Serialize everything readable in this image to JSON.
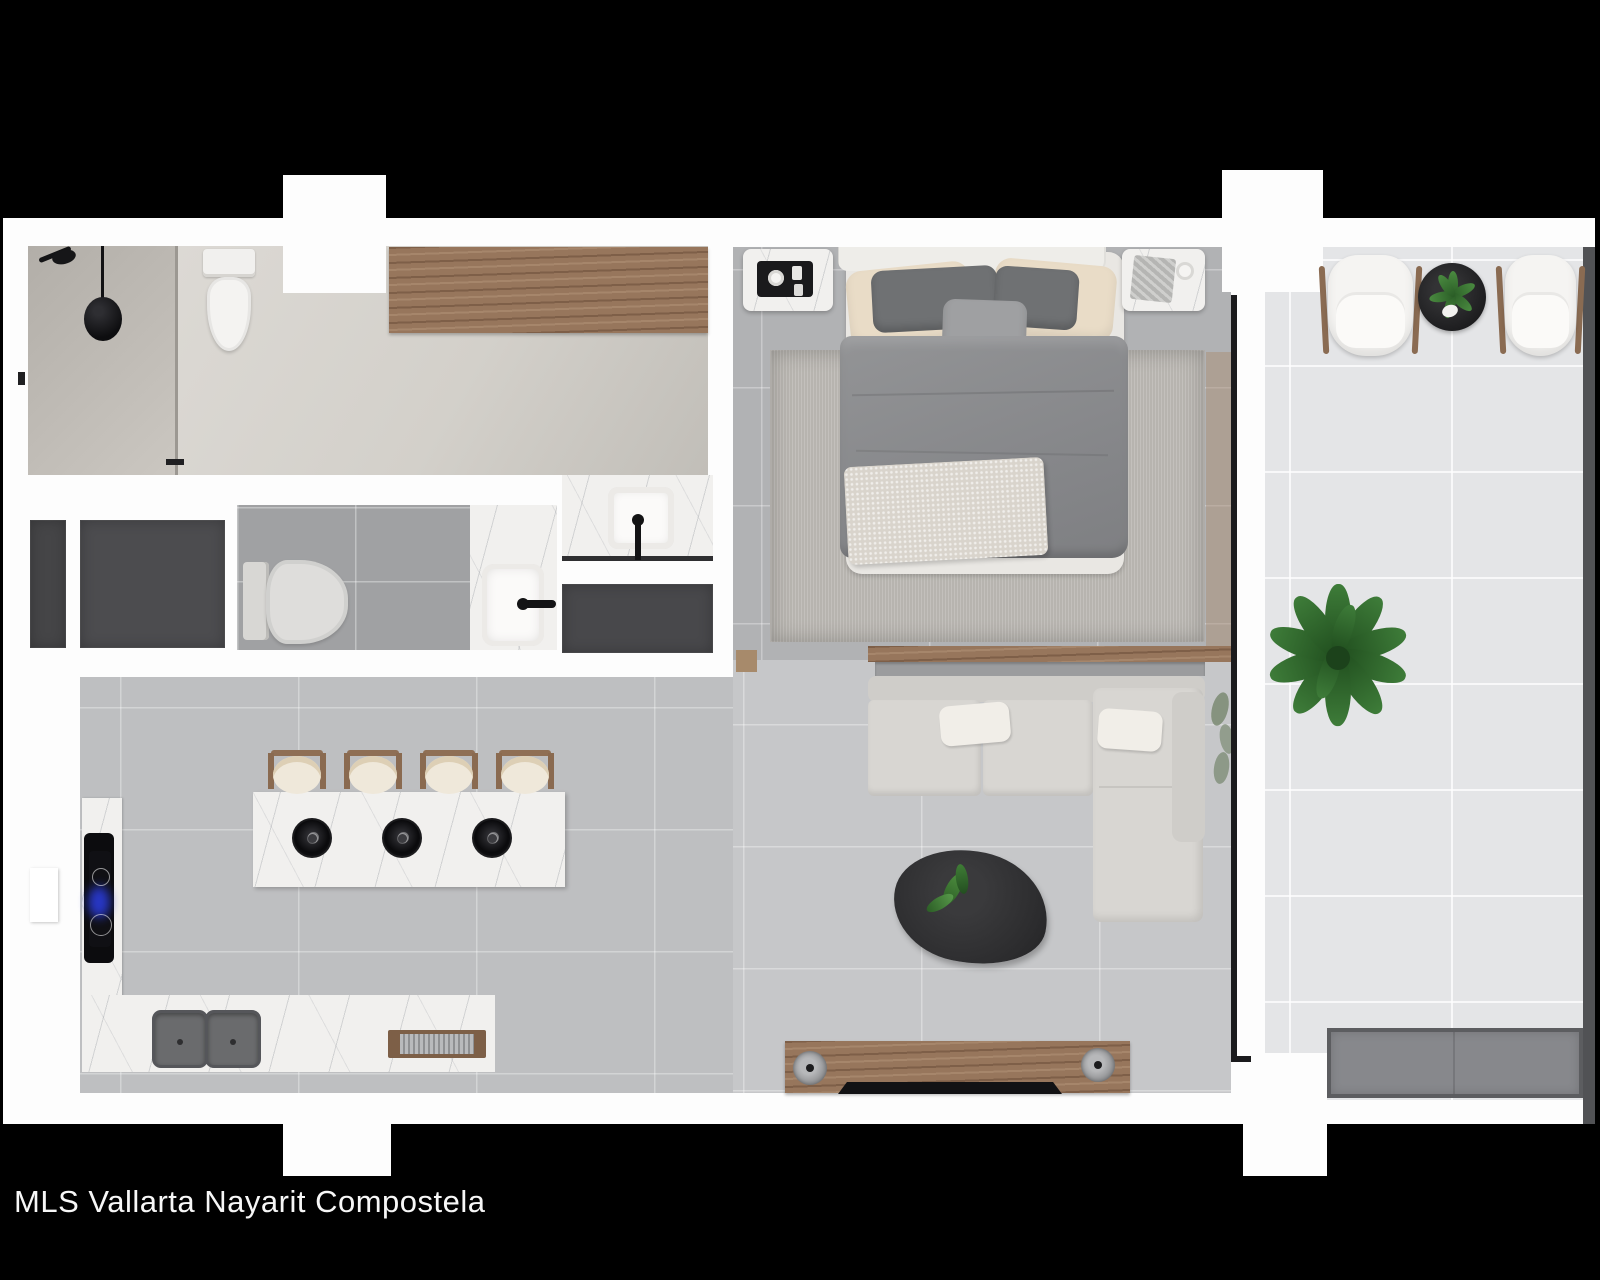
{
  "caption": {
    "text": "MLS Vallarta Nayarit Compostela"
  },
  "colors": {
    "background": "#000000",
    "wall": "#fdfdfd",
    "floor_kitchen": "#bebfc1",
    "floor_living": "#c6c7c9",
    "floor_bedroom": "#b1b2b4",
    "floor_balcony": "#e4e5e7",
    "floor_shower": "#b7b3ad",
    "floor_bath1": "#d6d3cd",
    "floor_bath2": "#a0a1a3",
    "marble": "#f1f0ee",
    "wood": "#97765c",
    "mat": "#48484b",
    "rug": "#b7b4af",
    "duvet": "#8d8e90",
    "sofa": "#d8d6d2",
    "pillow_cream": "#e9dcc7",
    "pillow_dark": "#6f7173",
    "table_black": "#2c2c2e",
    "plant": "#33702f",
    "plant_dark": "#1f4c1d",
    "bench": "#87888c",
    "window_line": "#1b1b1d",
    "edge_strip": "#515255",
    "cooktop_glow": "#2a3bd8",
    "text": "#f7f7f7"
  }
}
